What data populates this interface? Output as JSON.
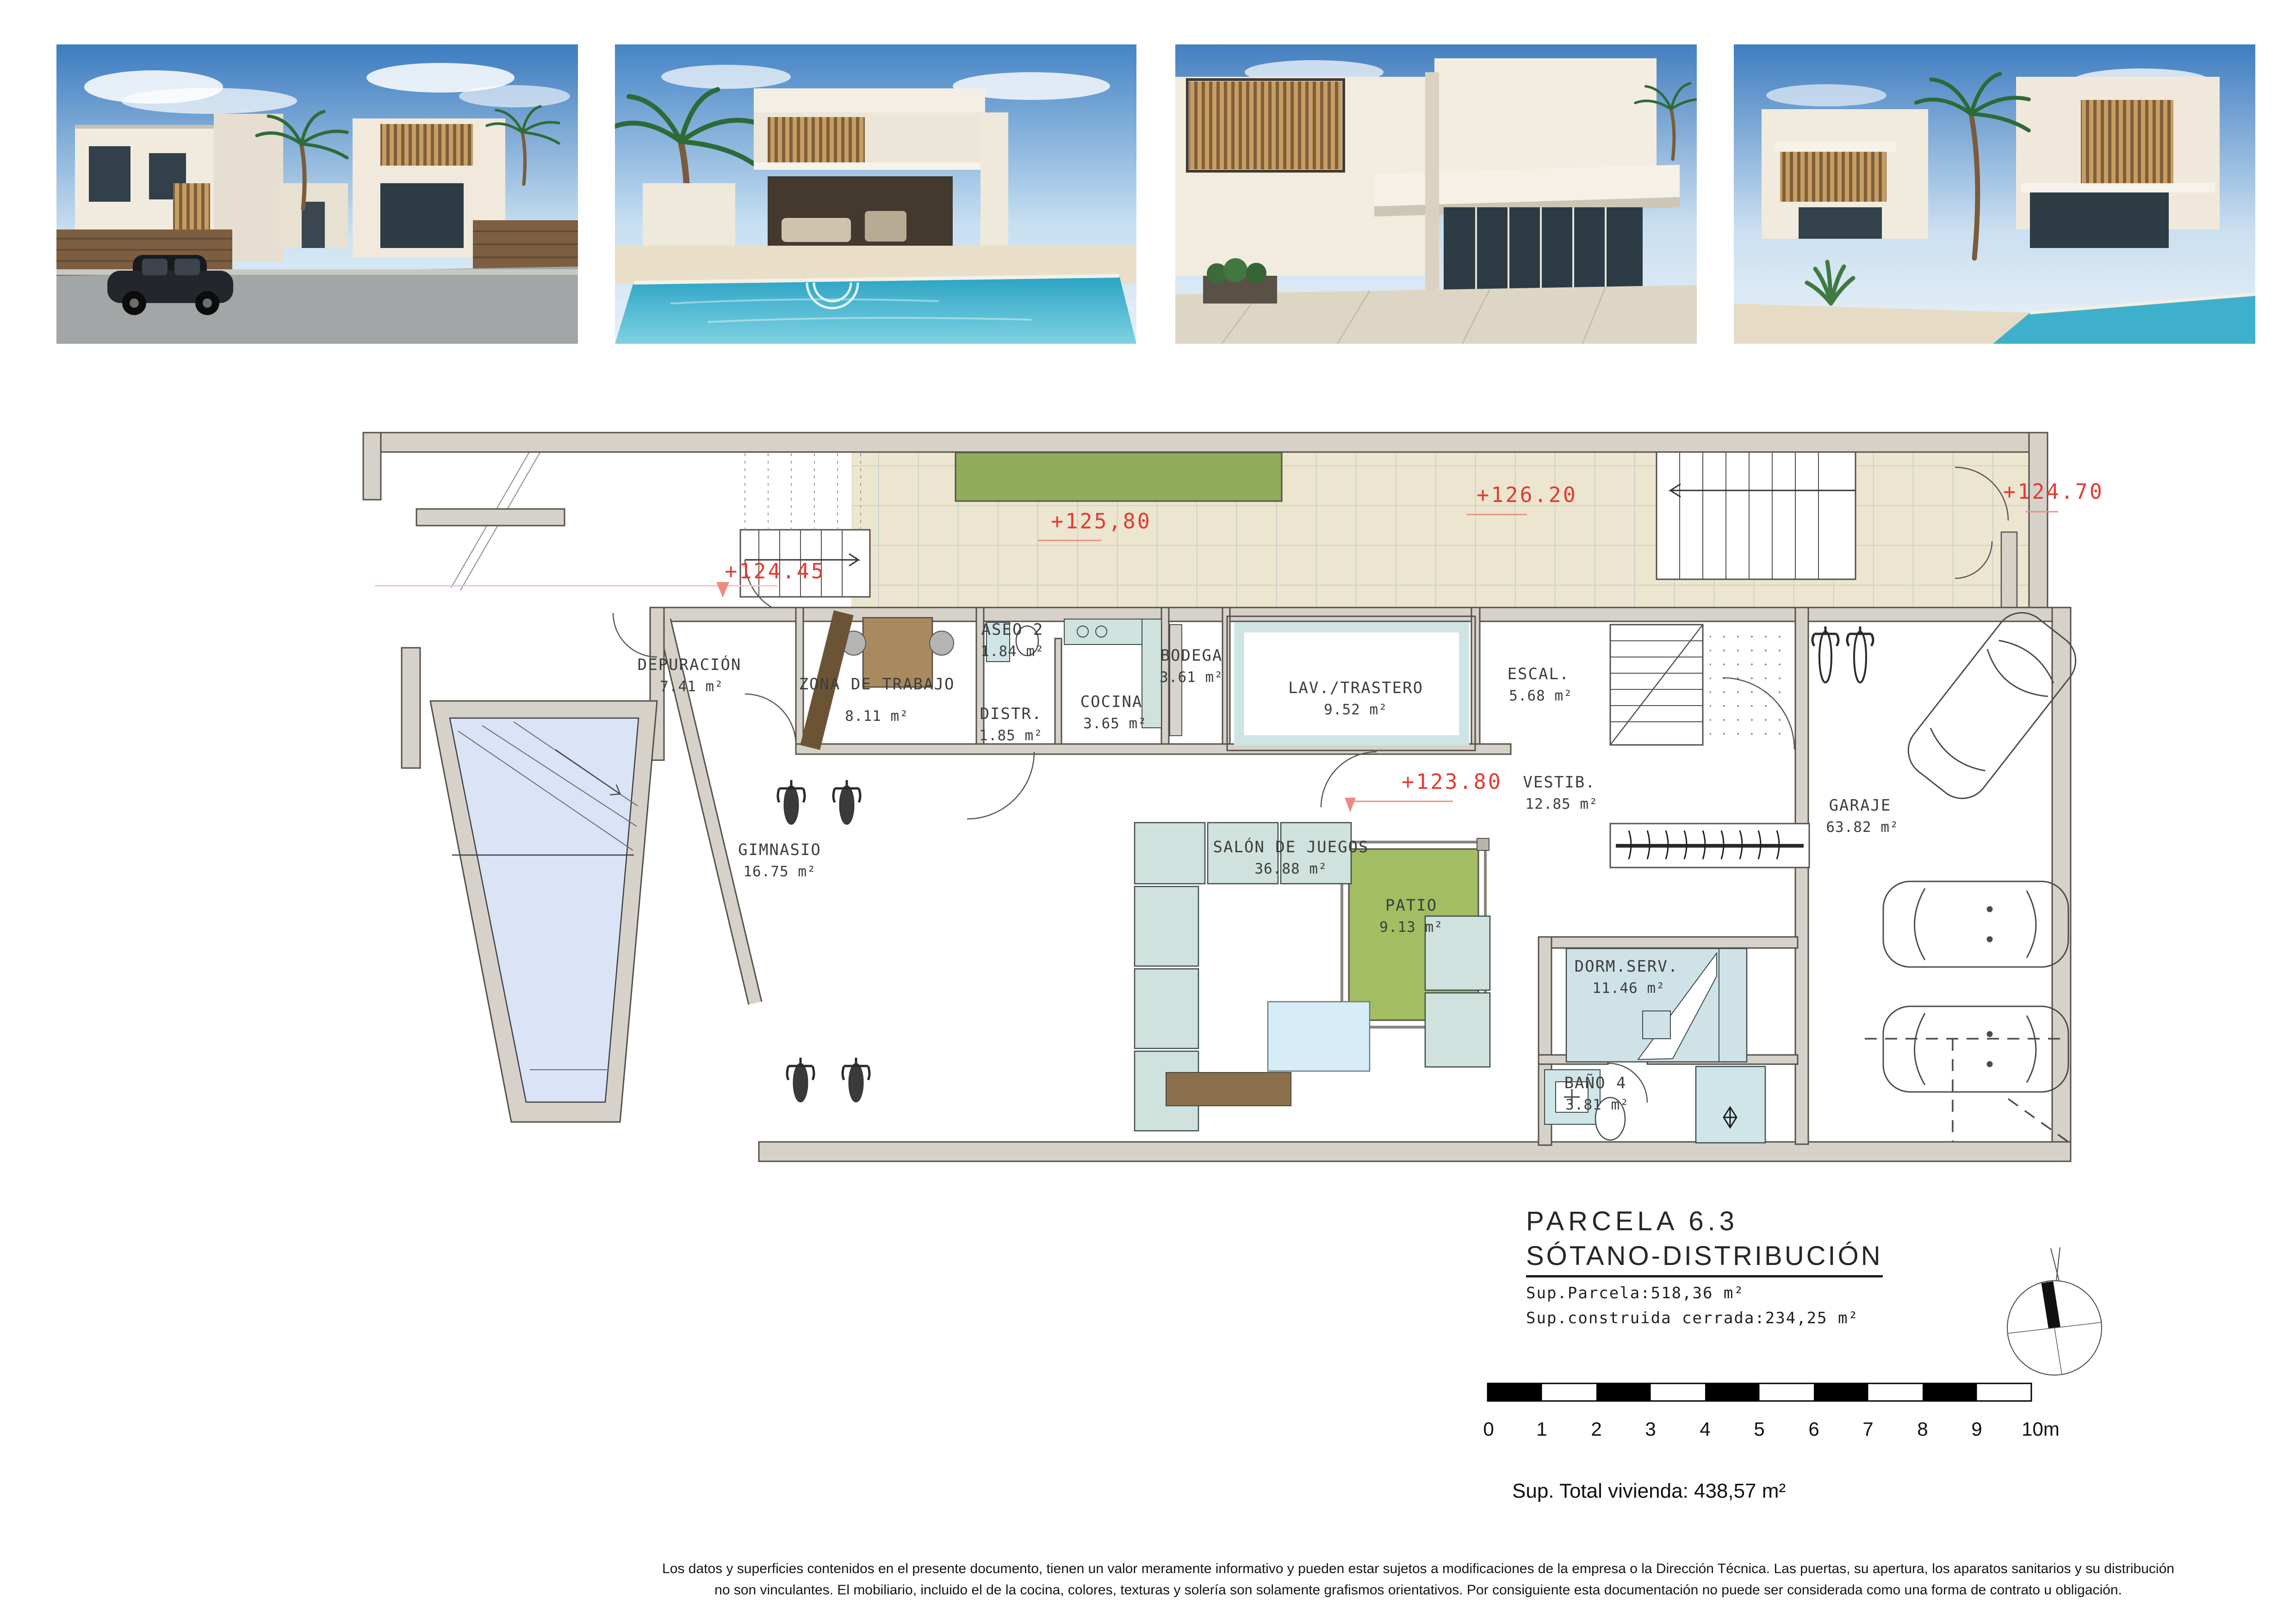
{
  "document": {
    "title": "PARCELA 6.3",
    "subtitle": "SÓTANO-DISTRIBUCIÓN",
    "sup_parcela": "Sup.Parcela:518,36  m²",
    "sup_construida": "Sup.construida cerrada:234,25  m²",
    "total": "Sup. Total vivienda: 438,57 m²",
    "disclaimer_line1": "Los datos y superficies contenidos en el presente documento, tienen un valor meramente informativo y pueden estar sujetos a modificaciones de la empresa o la Dirección Técnica. Las puertas, su apertura, los aparatos sanitarios y su distribución",
    "disclaimer_line2": "no son vinculantes. El mobiliario, incluido el de la cocina, colores, texturas y solería son solamente grafismos orientativos. Por consiguiente esta documentación no puede ser considerada como una forma de contrato u obligación."
  },
  "plan": {
    "rooms": [
      {
        "name": "DEPURACIÓN",
        "area": "7.41 m²"
      },
      {
        "name": "ZONA DE TRABAJO",
        "area": "8.11 m²"
      },
      {
        "name": "ASEO 2",
        "area": "1.84 m²"
      },
      {
        "name": "DISTR.",
        "area": "1.85 m²"
      },
      {
        "name": "COCINA",
        "area": "3.65 m²"
      },
      {
        "name": "BODEGA",
        "area": "3.61 m²"
      },
      {
        "name": "LAV./TRASTERO",
        "area": "9.52 m²"
      },
      {
        "name": "ESCAL.",
        "area": "5.68 m²"
      },
      {
        "name": "VESTIB.",
        "area": "12.85 m²"
      },
      {
        "name": "GIMNASIO",
        "area": "16.75 m²"
      },
      {
        "name": "SALÓN DE JUEGOS",
        "area": "36.88 m²"
      },
      {
        "name": "PATIO",
        "area": "9.13 m²"
      },
      {
        "name": "GARAJE",
        "area": "63.82 m²"
      },
      {
        "name": "DORM.SERV.",
        "area": "11.46 m²"
      },
      {
        "name": "BAÑO 4",
        "area": "3.81 m²"
      }
    ],
    "elevations": {
      "e12445": "+124.45",
      "e12580": "+125,80",
      "e12620": "+126.20",
      "e12470": "+124.70",
      "e12380": "+123.80"
    },
    "colors": {
      "accent_red": "#e23b31",
      "wall_gray": "#d7d2c9",
      "terrace_beige": "#ece5cf",
      "planter_green": "#8fad5a",
      "patio_green": "#a2bd62",
      "pool_blue": "#dbe4f6",
      "furniture_teal": "#cfe2dd"
    }
  },
  "scale_bar": {
    "labels": [
      "0",
      "1",
      "2",
      "3",
      "4",
      "5",
      "6",
      "7",
      "8",
      "9",
      "10m"
    ]
  }
}
